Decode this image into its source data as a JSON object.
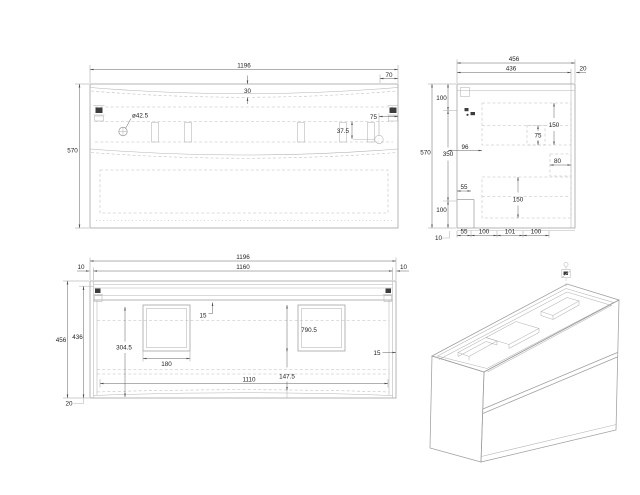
{
  "drawing": {
    "background": "#ffffff",
    "geometry_color": "#9e9e9e",
    "dashed_color": "#bdbdbd",
    "dimension_line_color": "#606060",
    "dimension_text_color": "#1f1f1f"
  },
  "front_view": {
    "overall_width": "1196",
    "right_end_offset": "70",
    "center_gap": "30",
    "overall_height": "570",
    "hole_diameter": "ø42.5",
    "hole_down_offset": "37.5",
    "hole_side_offset": "75"
  },
  "side_view": {
    "overall_depth": "456",
    "inner_depth": "436",
    "back_gap": "20",
    "overall_height": "570",
    "top_segment": "100",
    "middle_segment": "350",
    "bottom_segment": "100",
    "base_gap": "10",
    "slide_setback": "96",
    "upper_drawer_height": "150",
    "upper_recess": "75",
    "back_clearance": "80",
    "lower_drawer_height": "150",
    "front_recess": "55",
    "bottom_segments": [
      "55",
      "100",
      "101",
      "100"
    ]
  },
  "top_view": {
    "overall_width": "1196",
    "inner_width": "1160",
    "left_gap": "10",
    "right_gap": "10",
    "overall_depth": "456",
    "inner_depth": "436",
    "front_overhang": "20",
    "rail_offset": "15",
    "cutout_back_depth": "304.5",
    "cutout_width": "180",
    "cutout_span": "790.5",
    "cutout_front_offset": "147.5",
    "inner_span": "1110",
    "side_offset": "15"
  }
}
